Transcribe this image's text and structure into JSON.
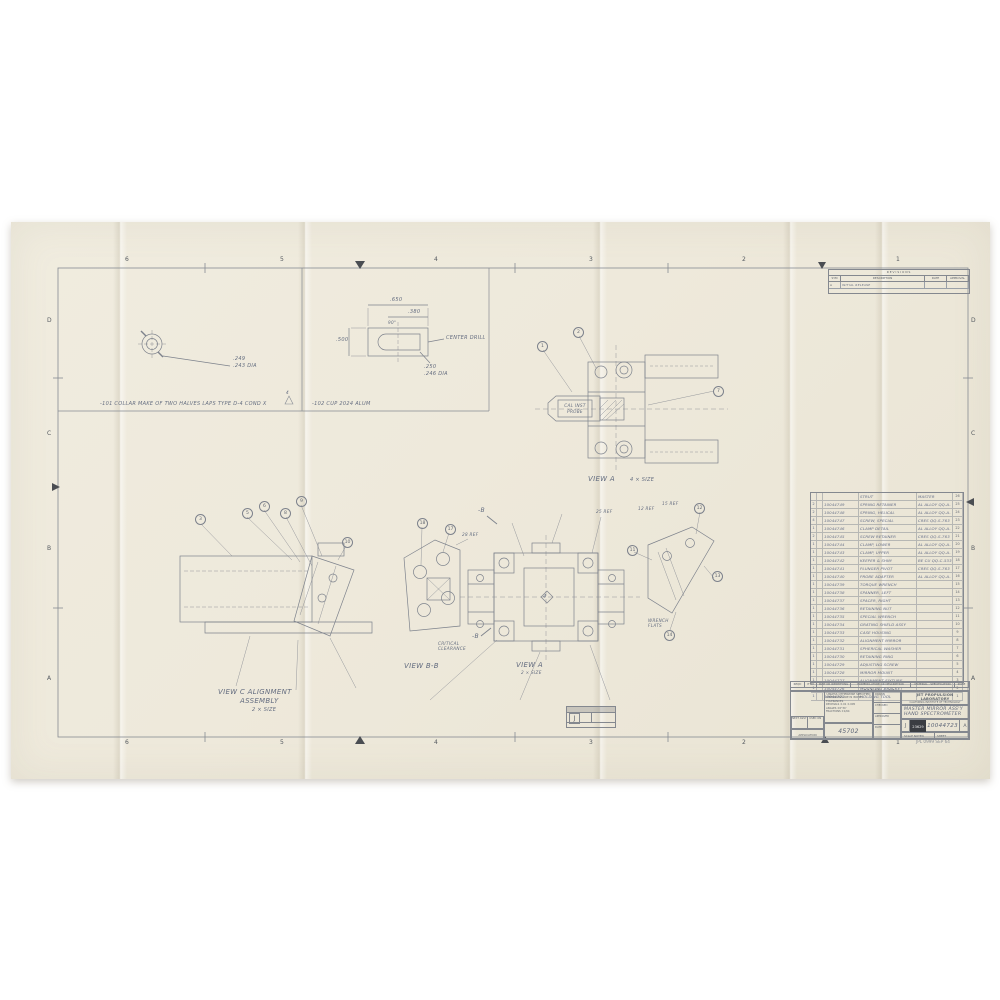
{
  "sheet": {
    "zones_top": [
      "6",
      "5",
      "4",
      "3",
      "2",
      "1"
    ],
    "zones_bottom": [
      "6",
      "5",
      "4",
      "3",
      "2",
      "1"
    ],
    "zones_left": [
      "D",
      "C",
      "B",
      "A"
    ],
    "zones_right": [
      "D",
      "C",
      "B",
      "A"
    ]
  },
  "notes": {
    "flag": "4",
    "note_101": "-101  COLLAR     MAKE OF TWO HALVES     LAPS TYPE D-4 COND X",
    "note_102": "-102  CUP     2024 ALUM"
  },
  "dims": {
    "collar_dia_1": ".249",
    "collar_dia_2": ".243 DIA",
    "cup_650": ".650",
    "cup_380": ".380",
    "cup_500": ".500",
    "cup_90": "90°",
    "center_drill": "CENTER DRILL",
    "cup_dia_1": ".250",
    "cup_dia_2": ".246 DIA",
    "ref_25": "25 REF",
    "ref_28": "28 REF",
    "ref_12": "12 REF",
    "ref_15": "15 REF"
  },
  "views": {
    "probe_1": "CAL INST",
    "probe_2": "PROBE",
    "view_a_top_name": "VIEW A",
    "view_a_top_scale": "4 × SIZE",
    "view_bb_name": "VIEW B-B",
    "view_a_mid_name": "VIEW A",
    "view_a_mid_scale": "2 × SIZE",
    "view_c_1": "VIEW C  ALIGNMENT",
    "view_c_2": "ASSEMBLY",
    "view_c_3": "2 × SIZE",
    "clearance_1": "CRITICAL",
    "clearance_2": "CLEARANCE",
    "wrench_1": "WRENCH",
    "wrench_2": "FLATS",
    "section_b_top": "-B",
    "section_b_bot": "-B",
    "diamond_item": "4"
  },
  "balloons": [
    "1",
    "2",
    "7",
    "3",
    "5",
    "6",
    "8",
    "9",
    "10",
    "11",
    "12",
    "13",
    "14",
    "17",
    "18"
  ],
  "revisions": {
    "title": "REVISIONS",
    "col_sym": "SYM",
    "col_desc": "DESCRIPTION",
    "col_date": "DATE",
    "col_appr": "APPROVAL",
    "r1_sym": "A",
    "r1_desc": "INITIAL RELEASE",
    "r1_date": "",
    "r1_appr": ""
  },
  "parts_list": {
    "header": {
      "q": "REQD",
      "item_h": "ITEM",
      "part": "PART OR IDENTIFYING NO",
      "desc": "NOMENCLATURE OR DESCRIPTION",
      "matl": "MATERIAL - SPECIFICATION",
      "zone": "ZONE",
      "strip": "PARTS LIST"
    },
    "rows": [
      {
        "q1": "",
        "q2": "",
        "part_no": "",
        "desc": "STRUT",
        "matl": "MASTER MIRROR ASSY",
        "item": "26"
      },
      {
        "q1": "2",
        "q2": "",
        "part_no": "10044749",
        "desc": "SPRING RETAINER",
        "matl": "AL ALLOY QQ-A-225/6",
        "item": "25"
      },
      {
        "q1": "2",
        "q2": "",
        "part_no": "10044748",
        "desc": "SPRING, HELICAL",
        "matl": "AL ALLOY QQ-A-225/6",
        "item": "24"
      },
      {
        "q1": "4",
        "q2": "",
        "part_no": "10044747",
        "desc": "SCREW, SPECIAL",
        "matl": "CRES QQ-S-763",
        "item": "23"
      },
      {
        "q1": "1",
        "q2": "",
        "part_no": "10044746",
        "desc": "CLAMP DETAIL",
        "matl": "AL ALLOY QQ-A-225/6",
        "item": "22"
      },
      {
        "q1": "2",
        "q2": "",
        "part_no": "10044745",
        "desc": "SCREW RETAINER",
        "matl": "CRES QQ-S-763",
        "item": "21"
      },
      {
        "q1": "1",
        "q2": "",
        "part_no": "10044744",
        "desc": "CLAMP, LOWER",
        "matl": "AL ALLOY QQ-A-225/6",
        "item": "20"
      },
      {
        "q1": "1",
        "q2": "",
        "part_no": "10044743",
        "desc": "CLAMP, UPPER",
        "matl": "AL ALLOY QQ-A-225/6",
        "item": "19"
      },
      {
        "q1": "1",
        "q2": "",
        "part_no": "10044742",
        "desc": "KEEPER & SHIM",
        "matl": "BE CU QQ-C-533",
        "item": "18"
      },
      {
        "q1": "1",
        "q2": "",
        "part_no": "10044741",
        "desc": "PLUNGER PIVOT",
        "matl": "CRES QQ-S-763",
        "item": "17"
      },
      {
        "q1": "1",
        "q2": "",
        "part_no": "10044740",
        "desc": "PROBE ADAPTER",
        "matl": "AL ALLOY QQ-A-225/6",
        "item": "16"
      },
      {
        "q1": "1",
        "q2": "",
        "part_no": "10044739",
        "desc": "TORQUE WRENCH",
        "matl": "",
        "item": "15"
      },
      {
        "q1": "1",
        "q2": "",
        "part_no": "10044738",
        "desc": "SPANNER, LEFT",
        "matl": "",
        "item": "14"
      },
      {
        "q1": "1",
        "q2": "",
        "part_no": "10044737",
        "desc": "SPACER, RIGHT",
        "matl": "",
        "item": "13"
      },
      {
        "q1": "1",
        "q2": "",
        "part_no": "10044736",
        "desc": "RETAINING NUT",
        "matl": "",
        "item": "12"
      },
      {
        "q1": "1",
        "q2": "",
        "part_no": "10044735",
        "desc": "SPECIAL WRENCH",
        "matl": "",
        "item": "11"
      },
      {
        "q1": "1",
        "q2": "",
        "part_no": "10044734",
        "desc": "GRATING SHIELD ASSY",
        "matl": "",
        "item": "10"
      },
      {
        "q1": "1",
        "q2": "",
        "part_no": "10044733",
        "desc": "CASE HOUSING",
        "matl": "",
        "item": "9"
      },
      {
        "q1": "1",
        "q2": "",
        "part_no": "10044732",
        "desc": "ALIGNMENT MIRROR",
        "matl": "",
        "item": "8"
      },
      {
        "q1": "1",
        "q2": "",
        "part_no": "10044731",
        "desc": "SPHERICAL WASHER",
        "matl": "",
        "item": "7"
      },
      {
        "q1": "1",
        "q2": "",
        "part_no": "10044730",
        "desc": "RETAINING RING",
        "matl": "",
        "item": "6"
      },
      {
        "q1": "1",
        "q2": "",
        "part_no": "10044729",
        "desc": "ADJUSTING SCREW",
        "matl": "",
        "item": "5"
      },
      {
        "q1": "1",
        "q2": "",
        "part_no": "10044728",
        "desc": "MIRROR MOUNT",
        "matl": "",
        "item": "4"
      },
      {
        "q1": "1",
        "q2": "",
        "part_no": "10044727",
        "desc": "ALIGNMENT FIXTURE",
        "matl": "",
        "item": "3"
      },
      {
        "q1": "1",
        "q2": "",
        "part_no": "10044726",
        "desc": "MOUNTING BRACKET",
        "matl": "",
        "item": "2"
      },
      {
        "q1": "1",
        "q2": "",
        "part_no": "10044725",
        "desc": "HOLDING TOOL",
        "matl": "",
        "item": "1"
      }
    ]
  },
  "title_block": {
    "org_1": "JET PROPULSION LABORATORY",
    "org_2": "CALIFORNIA INSTITUTE OF TECHNOLOGY",
    "org_3": "PASADENA, CALIFORNIA",
    "title_1": "MASTER MIRROR ASS'Y",
    "title_2": "HAND SPECTROMETER",
    "size": "J",
    "code_ident": "23629",
    "dwg_no": "10044723",
    "rev": "A",
    "scale_text": "SCALE  NOTED",
    "sheet_text": "SHEET",
    "tol_title": "UNLESS OTHERWISE SPECIFIED",
    "tol_1": "DIMENSIONS ARE IN INCHES",
    "tol_2": "TOLERANCES",
    "tol_3": "DECIMALS ±.01  ±.005",
    "tol_4": "ANGLES ±0°30'",
    "tol_5": "FRACTIONS ±1/64",
    "appl_next": "NEXT ASSY",
    "appl_used": "USED ON",
    "appl_label": "APPLICATION",
    "appl_value": "45702",
    "sig_drawn": "DRAWN",
    "sig_checked": "CHECKED",
    "sig_approved": "APPROVED",
    "sig_date": "DATE"
  },
  "stamp": {
    "letter": "J"
  },
  "form_note": "JPL 0999  SEP 64"
}
